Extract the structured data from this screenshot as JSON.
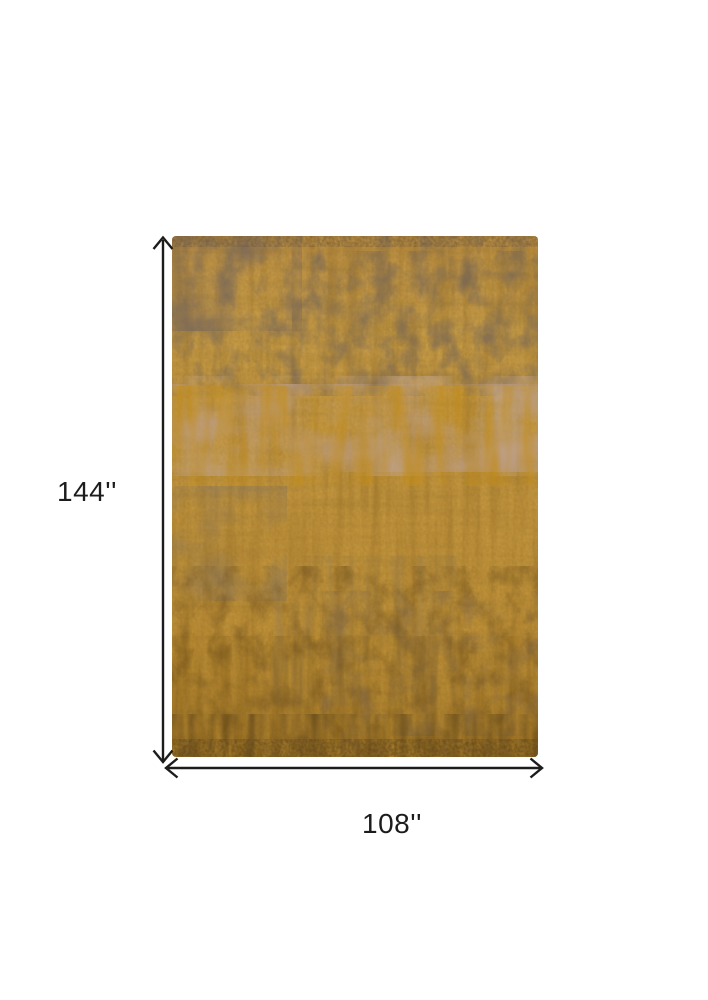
{
  "figure": {
    "description": "Product dimension diagram of a distressed abstract area rug in gold and gray-brown tones",
    "height_label": "144''",
    "width_label": "108''"
  },
  "colors": {
    "background": "#ffffff",
    "dimension_lines": "#1c1c1c",
    "label_text": "#1c1c1c",
    "rug_base_gold": "#c49743",
    "rug_light_gold": "#cda14c",
    "rug_dark_amber": "#8a6320",
    "rug_gray_brown": "#7d6b55",
    "rug_pink_tan": "#bb9b82",
    "rug_deep_brown": "#5c431c"
  }
}
